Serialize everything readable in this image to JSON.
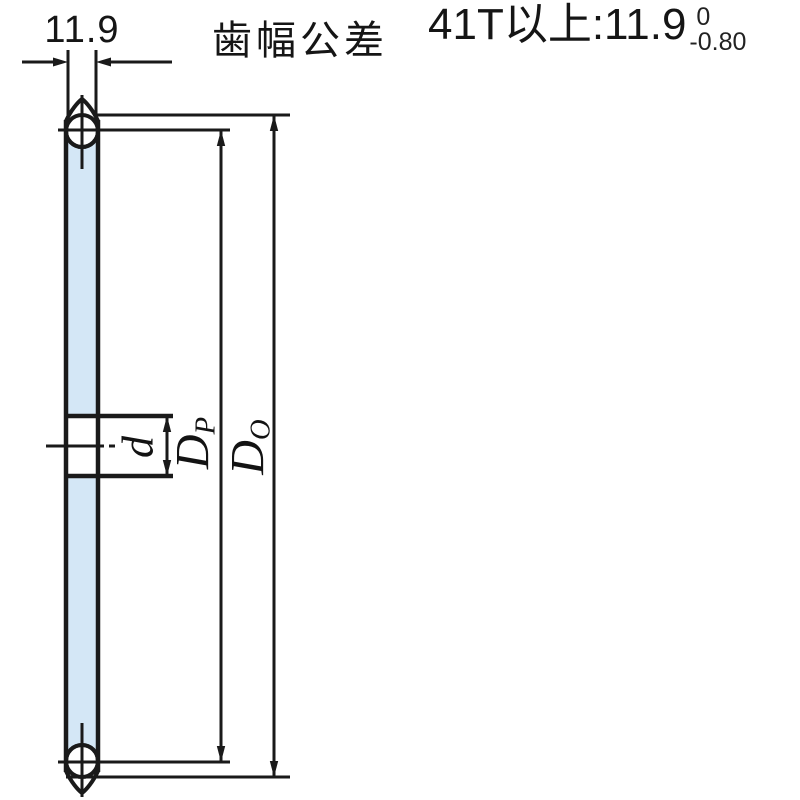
{
  "header": {
    "width_dim": "11.9",
    "title": "歯幅公差",
    "spec_label": "41T以上:11.9",
    "tolerance_upper": "0",
    "tolerance_lower": "-0.80"
  },
  "labels": {
    "bore_diameter": "d",
    "pitch_diameter_main": "D",
    "pitch_diameter_sub": "P",
    "outer_diameter_main": "D",
    "outer_diameter_sub": "O"
  },
  "colors": {
    "line": "#1a1a1a",
    "plate_fill": "#d4e7f6",
    "background": "#ffffff"
  }
}
